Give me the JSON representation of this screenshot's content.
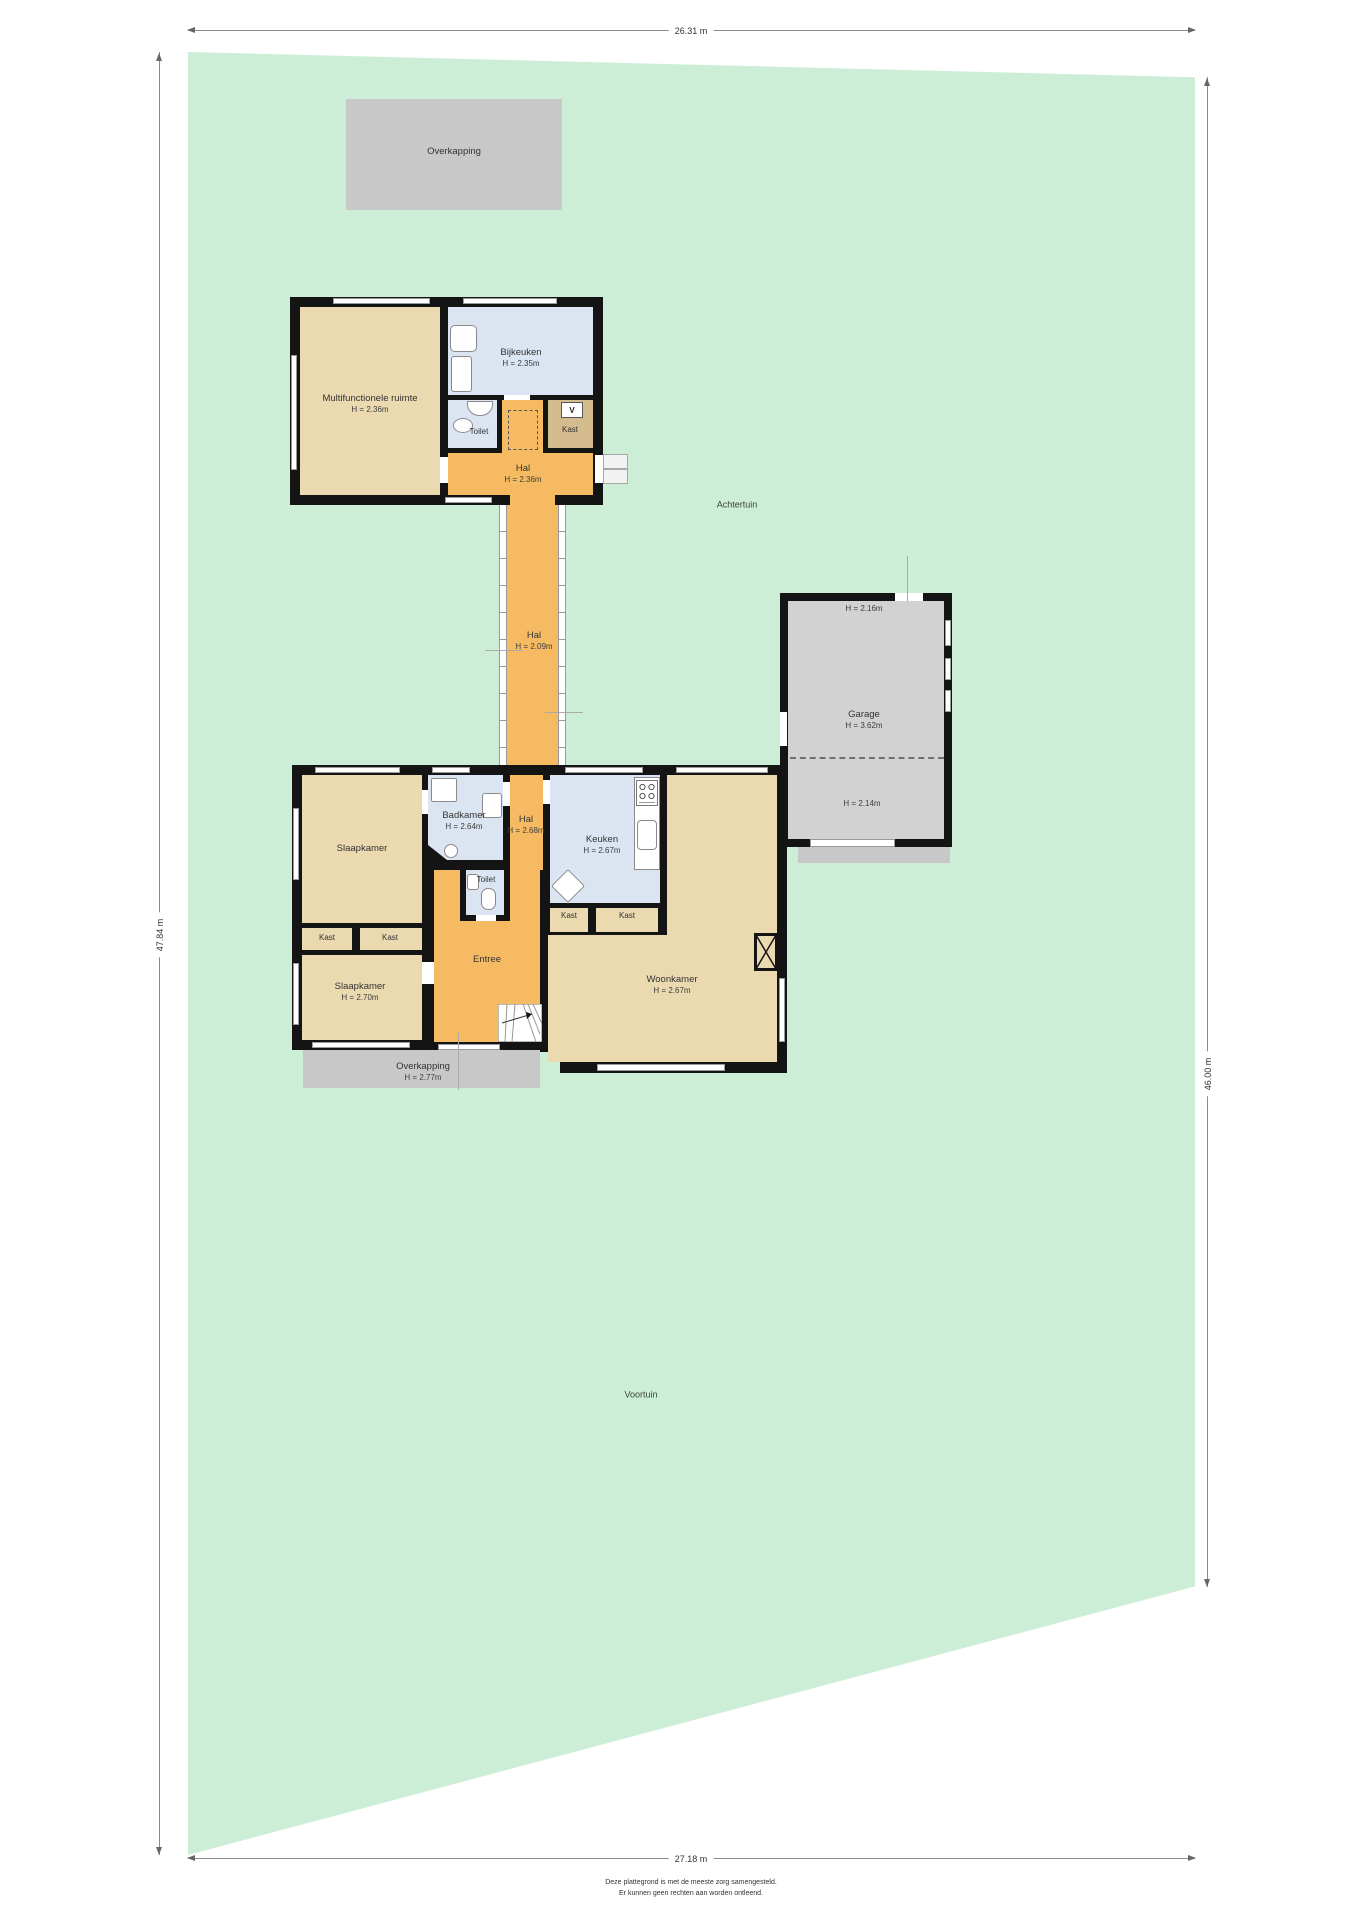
{
  "page": {
    "disclaimer": [
      "Deze plattegrond is met de meeste zorg samengesteld.",
      "Er kunnen geen rechten aan worden ontleend."
    ]
  },
  "dimensions": {
    "top": "26.31 m",
    "bottom": "27.18 m",
    "left": "47.84 m",
    "right": "46.00 m"
  },
  "garden": {
    "back": "Achtertuin",
    "front": "Voortuin"
  },
  "colors": {
    "garden_green": "#cdeed6",
    "room_tan": "#ebd9b0",
    "hall_orange": "#f6bb62",
    "wet_room_blue": "#dbe5f1",
    "closet_brown": "#d4bc8f",
    "structure_gray": "#c8c8c8",
    "wall_black": "#141414"
  },
  "upper_building": {
    "multifunctionele_ruimte": {
      "label": "Multifunctionele ruimte",
      "height": "H = 2.36m"
    },
    "bijkeuken": {
      "label": "Bijkeuken",
      "height": "H = 2.35m"
    },
    "toilet": {
      "label": "Toilet"
    },
    "kast": {
      "label": "Kast",
      "symbol": "V"
    },
    "hal": {
      "label": "Hal",
      "height": "H = 2.36m"
    }
  },
  "corridor": {
    "label": "Hal",
    "height": "H = 2.09m"
  },
  "main_building": {
    "slaapkamer_1": {
      "label": "Slaapkamer"
    },
    "badkamer": {
      "label": "Badkamer",
      "height": "H = 2.64m"
    },
    "hal": {
      "label": "Hal",
      "height": "H = 2.68m"
    },
    "toilet": {
      "label": "Toilet"
    },
    "kast_1": {
      "label": "Kast"
    },
    "kast_2": {
      "label": "Kast"
    },
    "slaapkamer_2": {
      "label": "Slaapkamer",
      "height": "H = 2.70m"
    },
    "entree": {
      "label": "Entree"
    },
    "keuken": {
      "label": "Keuken",
      "height": "H = 2.67m"
    },
    "kast_3": {
      "label": "Kast"
    },
    "kast_4": {
      "label": "Kast"
    },
    "woonkamer": {
      "label": "Woonkamer",
      "height": "H = 2.67m"
    }
  },
  "garage": {
    "label": "Garage",
    "height": "H = 3.62m",
    "top_height": "H = 2.16m",
    "bottom_height": "H = 2.14m"
  },
  "overkapping_top": {
    "label": "Overkapping"
  },
  "overkapping_front": {
    "label": "Overkapping",
    "height": "H = 2.77m"
  }
}
